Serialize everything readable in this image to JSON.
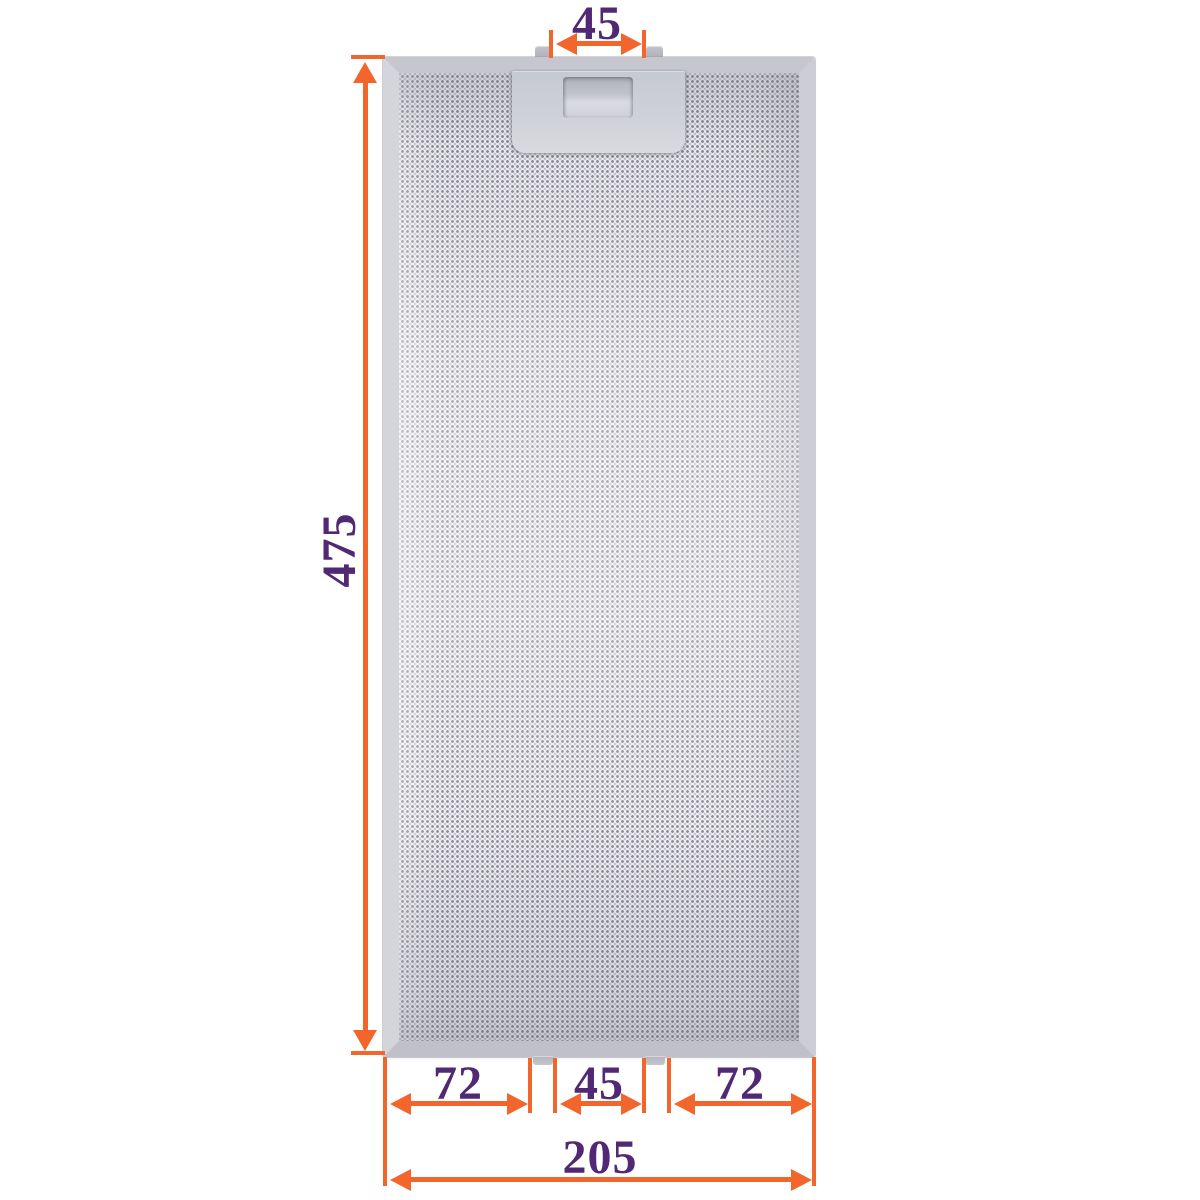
{
  "figure": {
    "type": "product-dimension-diagram",
    "subject": "metal-mesh-grease-filter"
  },
  "colors": {
    "dimension_accent": "#F2652C",
    "dimension_text": "#512873",
    "frame_silver": "#C9C9D1",
    "background": "#FFFFFF"
  },
  "dimensions": {
    "top_tab_width": "45",
    "height": "475",
    "bottom_left": "72",
    "bottom_center": "45",
    "bottom_right": "72",
    "total_width": "205"
  }
}
